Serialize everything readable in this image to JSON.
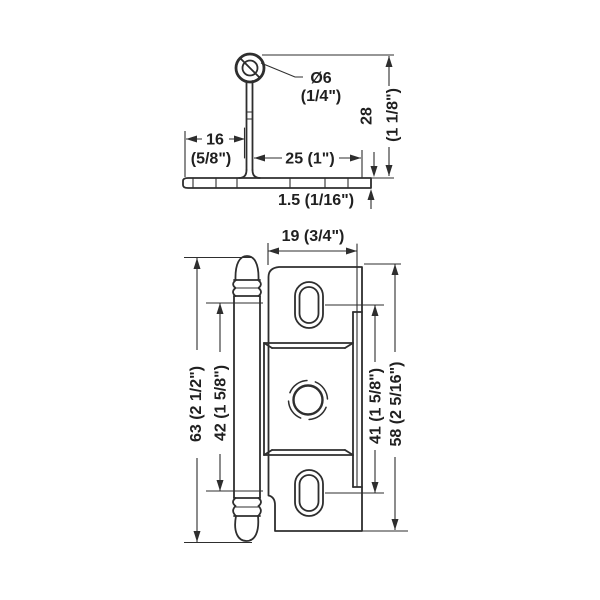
{
  "title": "Cabinet hinge technical drawing",
  "colors": {
    "background": "#ffffff",
    "line": "#2e2e2e"
  },
  "side_view": {
    "dims": {
      "pin_dia_metric": "Ø6",
      "pin_dia_imperial": "(1/4\")",
      "offset16_metric": "16",
      "offset16_imperial": "(5/8\")",
      "offset25": "25 (1\")",
      "height28_metric": "28",
      "height28_imperial": "(1 1/8\")",
      "thickness15": "1.5 (1/16\")"
    }
  },
  "front_view": {
    "dims": {
      "width19": "19 (3/4\")",
      "overall63": "63 (2 1/2\")",
      "knuckle42": "42 (1 5/8\")",
      "holes41": "41 (1 5/8\")",
      "plate58": "58 (2 5/16\")"
    }
  }
}
